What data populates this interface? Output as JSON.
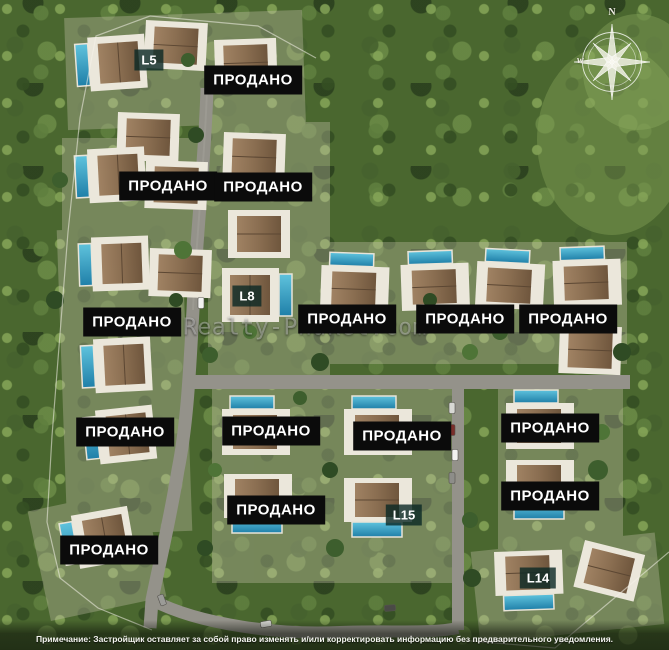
{
  "plan": {
    "sold_label": "ПРОДАНО",
    "sold_markers": [
      {
        "x": 253,
        "y": 80
      },
      {
        "x": 168,
        "y": 186
      },
      {
        "x": 263,
        "y": 187
      },
      {
        "x": 132,
        "y": 322
      },
      {
        "x": 347,
        "y": 319
      },
      {
        "x": 465,
        "y": 319
      },
      {
        "x": 568,
        "y": 319
      },
      {
        "x": 125,
        "y": 432
      },
      {
        "x": 271,
        "y": 431
      },
      {
        "x": 402,
        "y": 436
      },
      {
        "x": 550,
        "y": 428
      },
      {
        "x": 276,
        "y": 510
      },
      {
        "x": 550,
        "y": 496
      },
      {
        "x": 109,
        "y": 550
      }
    ],
    "lot_markers": [
      {
        "label": "L5",
        "x": 149,
        "y": 60
      },
      {
        "label": "L8",
        "x": 247,
        "y": 296
      },
      {
        "label": "L15",
        "x": 404,
        "y": 515
      },
      {
        "label": "L14",
        "x": 538,
        "y": 578
      }
    ],
    "watermark": "Realty-Phuket.com",
    "compass": {
      "north": "N",
      "west": "w"
    },
    "footnote": "Примечание: Застройщик оставляет за собой право изменять и/или корректировать информацию без предварительного уведомления.",
    "colors": {
      "sold_badge_bg": "#0b0b0b",
      "sold_badge_text": "#ffffff",
      "lot_badge_bg": "#0a2824",
      "forest_green": "#4a672f",
      "pool_blue": "#2d9dc4",
      "roof_brown": "#8a6e51",
      "road_gray": "#94928a"
    }
  }
}
